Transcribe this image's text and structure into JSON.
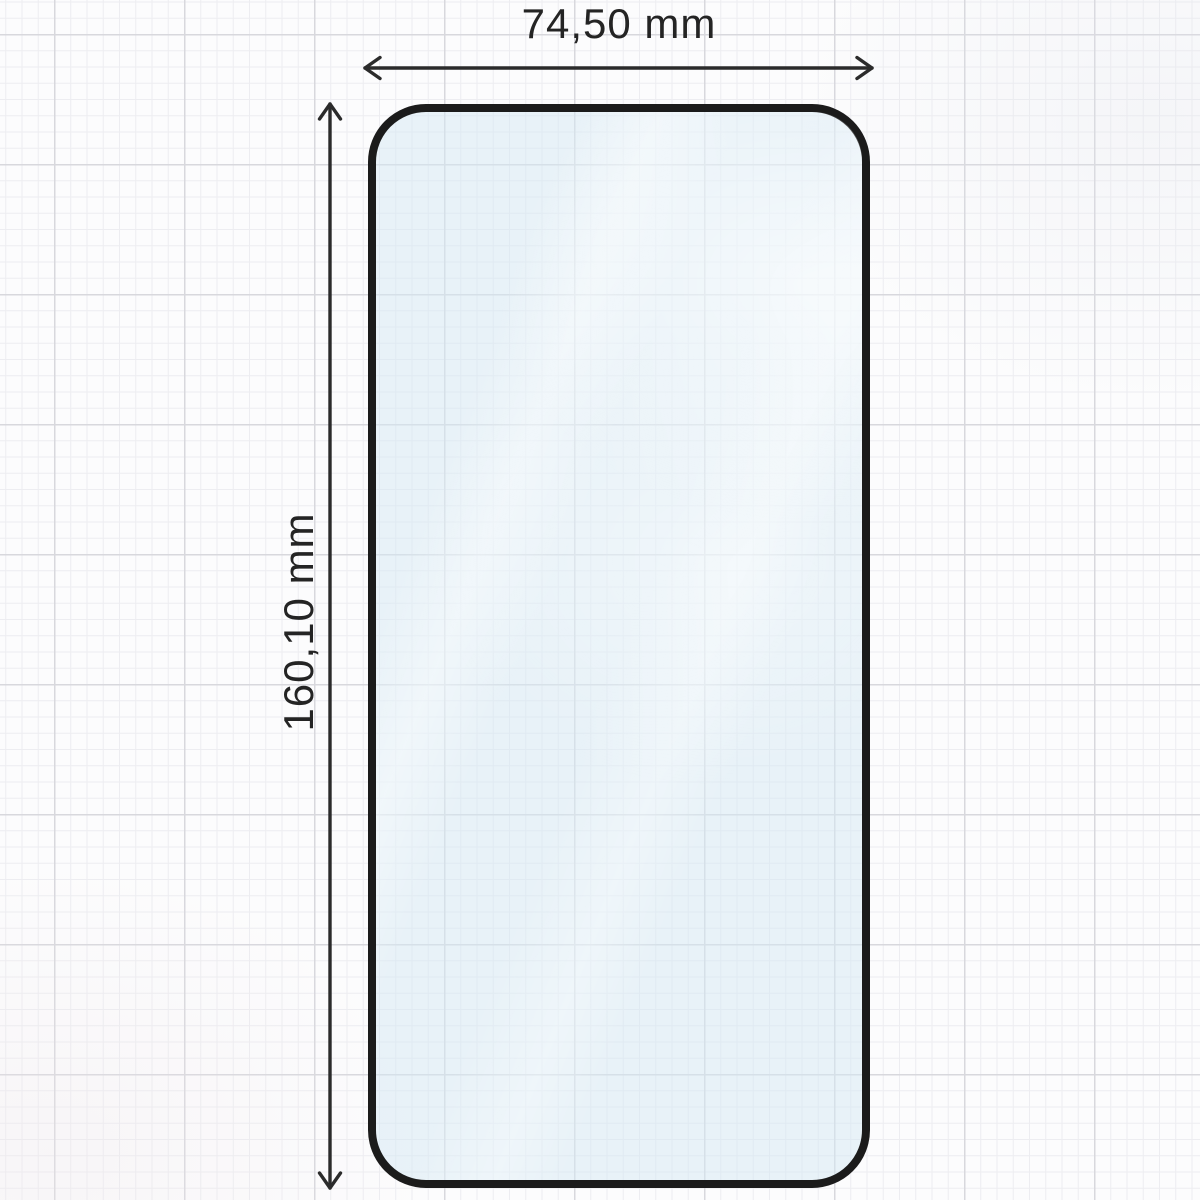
{
  "figure": {
    "type": "technical-dimension-diagram",
    "subject": "screen protector glass outline on graph paper"
  },
  "dimensions": {
    "width": {
      "label": "74,50 mm",
      "value_mm": 74.5
    },
    "height": {
      "label": "160,10 mm",
      "value_mm": 160.1
    }
  },
  "icons": {
    "width_arrow": "double-headed-horizontal-arrow-icon",
    "height_arrow": "double-headed-vertical-arrow-icon"
  },
  "colors": {
    "background": "#fcfcfd",
    "grid_minor": "#ededf1",
    "grid_major": "#d8d8dd",
    "glass_border": "#1b1b1b",
    "glass_fill": "rgba(211, 231, 243, 0.5)",
    "dimension_line": "#2b2b2b",
    "text": "#242424"
  }
}
